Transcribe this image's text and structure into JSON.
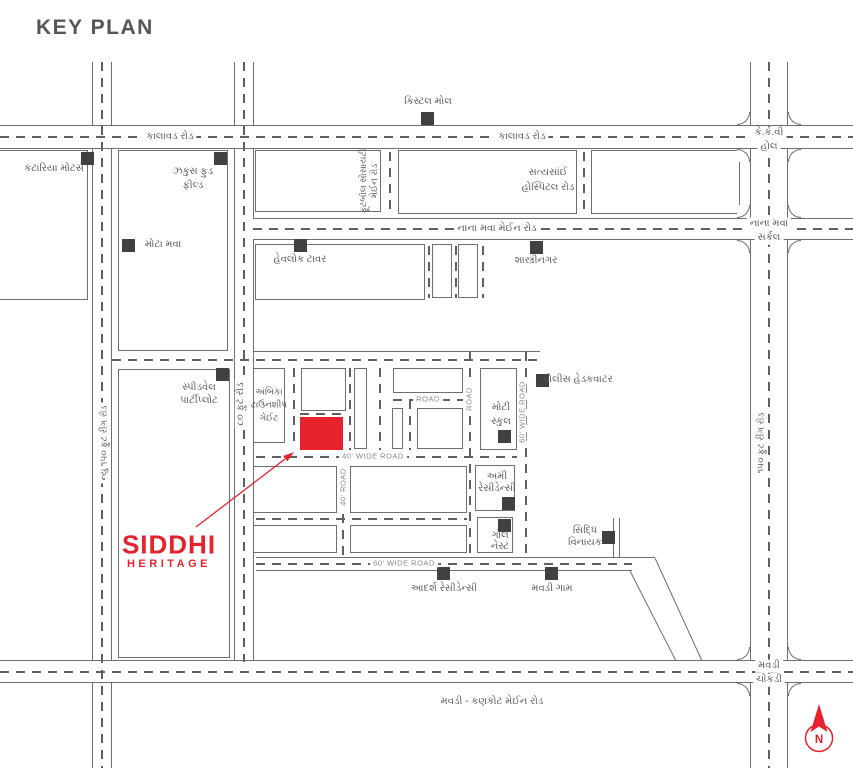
{
  "title": "KEY PLAN",
  "colors": {
    "accent_red": "#e8222d",
    "line_gray": "#6d6e71",
    "text_gray": "#55565a",
    "marker_dark": "#414042"
  },
  "roads": {
    "kalavad": "કાલાવડ રોડ",
    "nana_mava_main": "નાના મવા મેઈન રોડ",
    "mavdi_kankot_main": "મવડી - કણકોટ મેઈન રોડ",
    "new_150_ft_ring": "ન્યુ ૧૫૦ ફુટ રીંગ રોડ",
    "ring_150_ft": "૧૫૦ ફુટ રીંગ રોડ",
    "ft_80": "૮૦ ફુટ રોડ",
    "football_society_l1": "ફૂટબૉલ સોસાયટી",
    "football_society_l2": "મેઈન રોડ",
    "wide_40": "40' WIDE ROAD",
    "road_40": "40' ROAD",
    "wide_60_h": "60' WIDE ROAD",
    "wide_60_v": "60' WIDE ROAD",
    "road_h": "ROAD",
    "road_v": "ROAD"
  },
  "landmarks": {
    "crystal_mall": "કિસ્ટલ મોલ",
    "kkv_l1": "કે.કે.વી",
    "kkv_l2": "હોલ",
    "kataria_motors": "કટારિયા મોટર્સ",
    "zeus_l1": "ઝકુસ ફુડ",
    "zeus_l2": "ફીલ્ડ",
    "satyasai_l1": "સત્યસાંઈ",
    "satyasai_l2": "હોસ્પિટલ રોડ",
    "nana_mava_circle_l1": "નાના મવા",
    "nana_mava_circle_l2": "સર્કલ",
    "mota_mava": "મોટા મવા",
    "havelock_tower": "હેવલોક ટાવર",
    "shastrinagar": "શાસ્ત્રીનગર",
    "speedwell_l1": "સ્પીડવેલ",
    "speedwell_l2": "પાર્ટીપ્લોટ",
    "ambika_l1": "અંબિકા",
    "ambika_l2": "ટાઉનશીપ",
    "ambika_l3": "ગેઈટ",
    "police_hq": "પોલીસ હેડકવાટર",
    "moti_school_l1": "મોટી",
    "moti_school_l2": "સ્કુલ",
    "ami_l1": "અમી",
    "ami_l2": "રેસીડેન્સી",
    "gol_l1": "ગોલ",
    "gol_l2": "નેસ્ટ",
    "siddhi_vinayak_l1": "સિદ્ધિ",
    "siddhi_vinayak_l2": "વિનાયક",
    "adarsh_residency": "આદર્શ રેસીડેન્સી",
    "mavdi_gam": "મવડી ગામ",
    "mavdi_chokdi_l1": "મવડી",
    "mavdi_chokdi_l2": "ચોકડી"
  },
  "logo": {
    "line1": "SIDDHI",
    "line2": "HERITAGE"
  },
  "compass": {
    "label": "N"
  }
}
